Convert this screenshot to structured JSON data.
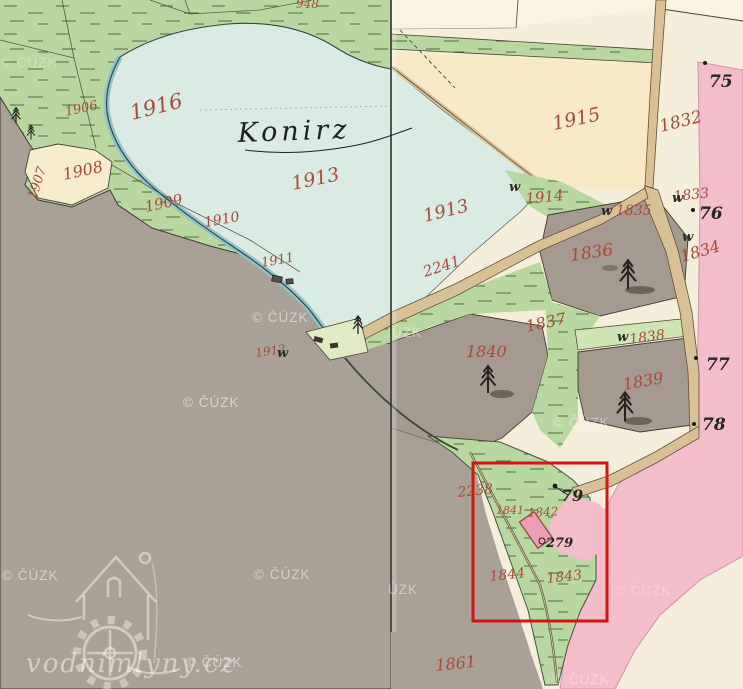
{
  "map": {
    "pond_name": "Konirz",
    "logo_text": "vodnimlyny.cz",
    "copyright_watermark": "© ČÚZK",
    "highlight_color": "#d61414",
    "colors": {
      "green_field": "#b9d7a0",
      "pond_water": "#d9ebe3",
      "pasture_gray": "#a9a195",
      "cream": "#f4eeda",
      "peach_field": "#f8e9c7",
      "pink_road": "#f3bdca",
      "road_tan": "#d9c197",
      "parcel_number_red": "#a84a3a"
    },
    "parcel_labels_red": [
      {
        "t": "1916",
        "x": 132,
        "y": 120,
        "r": -14,
        "s": 21
      },
      {
        "t": "1906",
        "x": 66,
        "y": 116,
        "r": -12,
        "s": 13
      },
      {
        "t": "1907",
        "x": 36,
        "y": 200,
        "r": -72,
        "s": 13
      },
      {
        "t": "1908",
        "x": 64,
        "y": 180,
        "r": -12,
        "s": 16
      },
      {
        "t": "1909",
        "x": 146,
        "y": 212,
        "r": -12,
        "s": 15
      },
      {
        "t": "1910",
        "x": 205,
        "y": 227,
        "r": -10,
        "s": 14
      },
      {
        "t": "1911",
        "x": 262,
        "y": 267,
        "r": -10,
        "s": 13
      },
      {
        "t": "1912",
        "x": 256,
        "y": 357,
        "r": -8,
        "s": 12
      },
      {
        "t": "1913",
        "x": 293,
        "y": 190,
        "r": -12,
        "s": 19
      },
      {
        "t": "1913",
        "x": 425,
        "y": 222,
        "r": -14,
        "s": 18
      },
      {
        "t": "1914",
        "x": 526,
        "y": 204,
        "r": -6,
        "s": 15
      },
      {
        "t": "1915",
        "x": 554,
        "y": 130,
        "r": -12,
        "s": 19
      },
      {
        "t": "1832",
        "x": 661,
        "y": 132,
        "r": -14,
        "s": 17
      },
      {
        "t": "1833",
        "x": 674,
        "y": 201,
        "r": -6,
        "s": 14
      },
      {
        "t": "1834",
        "x": 682,
        "y": 262,
        "r": -16,
        "s": 16
      },
      {
        "t": "1835",
        "x": 616,
        "y": 215,
        "r": 0,
        "s": 14
      },
      {
        "t": "1836",
        "x": 571,
        "y": 261,
        "r": -8,
        "s": 17
      },
      {
        "t": "1837",
        "x": 527,
        "y": 332,
        "r": -12,
        "s": 16
      },
      {
        "t": "1838",
        "x": 630,
        "y": 344,
        "r": -8,
        "s": 14
      },
      {
        "t": "1839",
        "x": 624,
        "y": 390,
        "r": -10,
        "s": 16
      },
      {
        "t": "1840",
        "x": 466,
        "y": 357,
        "r": 0,
        "s": 16
      },
      {
        "t": "1841",
        "x": 496,
        "y": 514,
        "r": 0,
        "s": 11
      },
      {
        "t": "1842",
        "x": 528,
        "y": 517,
        "r": -3,
        "s": 12
      },
      {
        "t": "1843",
        "x": 547,
        "y": 583,
        "r": -6,
        "s": 14
      },
      {
        "t": "1844",
        "x": 490,
        "y": 581,
        "r": -6,
        "s": 14
      },
      {
        "t": "1861",
        "x": 436,
        "y": 671,
        "r": -6,
        "s": 16
      },
      {
        "t": "2241",
        "x": 425,
        "y": 277,
        "r": -18,
        "s": 15
      },
      {
        "t": "2238",
        "x": 458,
        "y": 497,
        "r": -6,
        "s": 14
      },
      {
        "t": "948",
        "x": 296,
        "y": 8,
        "r": 0,
        "s": 12
      }
    ],
    "landmark_labels_black": [
      {
        "t": "75",
        "x": 709,
        "y": 87,
        "s": 17
      },
      {
        "t": "76",
        "x": 699,
        "y": 219,
        "s": 17
      },
      {
        "t": "77",
        "x": 706,
        "y": 370,
        "s": 17
      },
      {
        "t": "78",
        "x": 702,
        "y": 430,
        "s": 17
      },
      {
        "t": "79",
        "x": 561,
        "y": 501,
        "s": 16
      },
      {
        "t": "279",
        "x": 546,
        "y": 547,
        "s": 13
      }
    ],
    "meadow_marks": {
      "symbol": "w",
      "positions": [
        {
          "x": 509,
          "y": 191
        },
        {
          "x": 601,
          "y": 215
        },
        {
          "x": 672,
          "y": 202
        },
        {
          "x": 682,
          "y": 241
        },
        {
          "x": 617,
          "y": 341
        },
        {
          "x": 277,
          "y": 357
        }
      ]
    },
    "watermarks": [
      {
        "t": "© ČÚZK",
        "x": 1,
        "y": 67,
        "o": 0.3
      },
      {
        "t": "© ČÚZK",
        "x": 252,
        "y": 322,
        "o": 0.5
      },
      {
        "t": "ÚZK",
        "x": 392,
        "y": 337,
        "o": 0.45
      },
      {
        "t": "© ČÚZK",
        "x": 183,
        "y": 407,
        "o": 0.55
      },
      {
        "t": "© ČÚZK",
        "x": 553,
        "y": 427,
        "o": 0.4
      },
      {
        "t": "© ČÚZK",
        "x": 2,
        "y": 580,
        "o": 0.5
      },
      {
        "t": "© ČÚZK",
        "x": 254,
        "y": 579,
        "o": 0.5
      },
      {
        "t": "ÚZK",
        "x": 388,
        "y": 594,
        "o": 0.45
      },
      {
        "t": "© ČÚZK",
        "x": 615,
        "y": 595,
        "o": 0.28
      },
      {
        "t": "© ČÚZK",
        "x": 553,
        "y": 684,
        "o": 0.35
      },
      {
        "t": "© ČÚZK",
        "x": 186,
        "y": 667,
        "o": 0.5
      }
    ]
  }
}
